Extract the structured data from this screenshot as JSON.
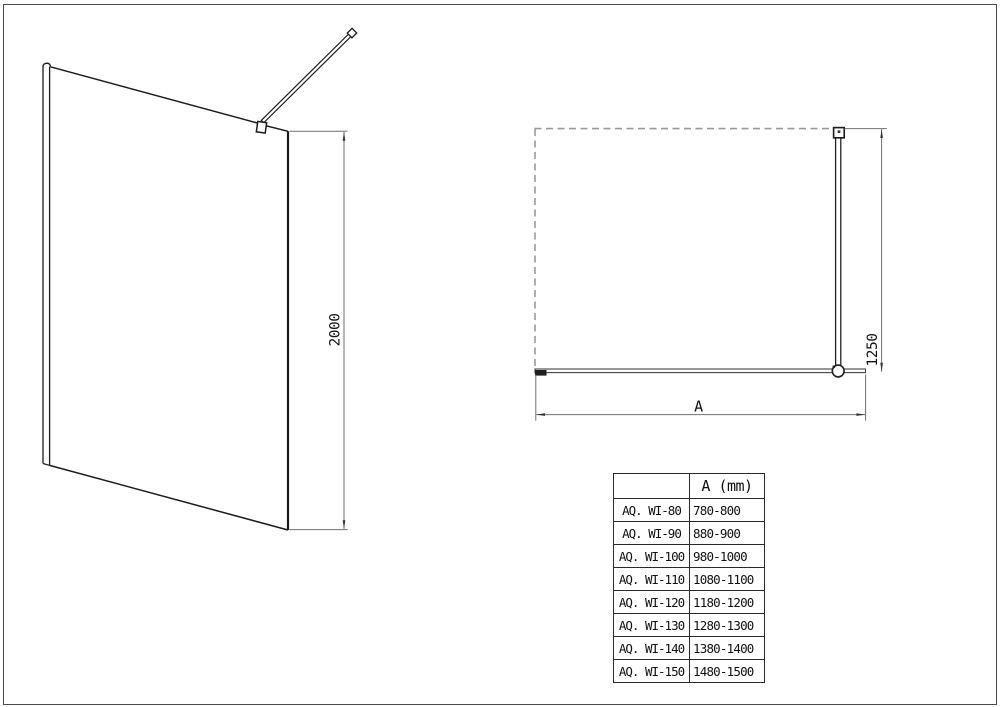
{
  "perspective_view": {
    "height_dim": "2000"
  },
  "plan_view": {
    "depth_dim": "1250",
    "width_dim": "A"
  },
  "size_table": {
    "col_model_header": "",
    "col_a_header": "A (mm)",
    "rows": [
      {
        "model": "AQ. WI-80",
        "a_range": "780-800"
      },
      {
        "model": "AQ. WI-90",
        "a_range": "880-900"
      },
      {
        "model": "AQ. WI-100",
        "a_range": "980-1000"
      },
      {
        "model": "AQ. WI-110",
        "a_range": "1080-1100"
      },
      {
        "model": "AQ. WI-120",
        "a_range": "1180-1200"
      },
      {
        "model": "AQ. WI-130",
        "a_range": "1280-1300"
      },
      {
        "model": "AQ. WI-140",
        "a_range": "1380-1400"
      },
      {
        "model": "AQ. WI-150",
        "a_range": "1480-1500"
      }
    ]
  },
  "colors": {
    "object_line": "#1c1c1c",
    "dimension_line": "#707070",
    "dashed_line": "#9a9a9a",
    "arrow_fill": "#333333"
  }
}
